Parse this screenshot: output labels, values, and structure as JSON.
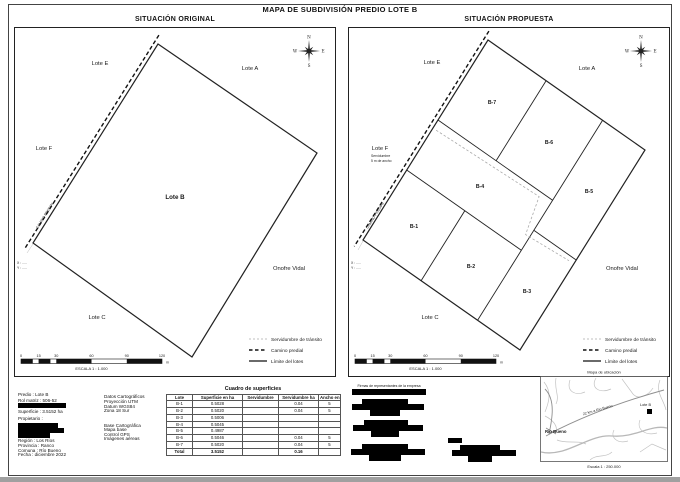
{
  "page": {
    "title": "MAPA DE SUBDIVISIÓN PREDIO LOTE B"
  },
  "panels": {
    "original": {
      "title": "SITUACIÓN ORIGINAL",
      "main_lot": "Lote B"
    },
    "proposed": {
      "title": "SITUACIÓN PROPUESTA",
      "lots": [
        "B-1",
        "B-2",
        "B-3",
        "B-4",
        "B-5",
        "B-6",
        "B-7"
      ],
      "servidumbre_note_line1": "Servidumbre",
      "servidumbre_note_line2": "5 m de ancho"
    }
  },
  "labels": {
    "lote_e": "Lote E",
    "lote_a": "Lote A",
    "lote_f": "Lote F",
    "lote_c": "Lote C",
    "neighbor_owner": "Onofre Vidal",
    "camino": "CAMINO PREDIAL",
    "coord_x": "X : .....",
    "coord_y": "Y : ....."
  },
  "compass": {
    "n": "N",
    "e": "E",
    "s": "S",
    "w": "W"
  },
  "legend": {
    "items": [
      {
        "label": "Servidumbre de tránsito",
        "style": "dash-light"
      },
      {
        "label": "Camino predial",
        "style": "dash-bold"
      },
      {
        "label": "Límite del lotes",
        "style": "solid"
      }
    ]
  },
  "scalebar": {
    "ticks": [
      "0",
      "15",
      "30",
      "60",
      "90",
      "120"
    ],
    "unit": "m",
    "label": "ESCALA 1 : 1.000"
  },
  "footer": {
    "info": {
      "predio": "Predio : Lote B",
      "rol": "Rol matriz : 506-52",
      "superficie": "Superficie : 3.5152 ha",
      "propietario": "Propietario :",
      "region": "Región : Los Ríos",
      "provincia": "Provincia : Ranco",
      "comuna": "Comuna : Río Bueno",
      "fecha": "Fecha : diciembre 2022"
    },
    "carto": {
      "title": "Datos Cartográficos",
      "l1": "Proyección UTM",
      "l2": "Datum WGS84",
      "l3": "Zona 18 Sur",
      "base_title": "Base Cartográfica",
      "b1": "Mapa base",
      "b2": "Control GPS",
      "b3": "Imágenes aéreas"
    },
    "table": {
      "title": "Cuadro de superficies",
      "headers": [
        "Lote",
        "Superficie en ha",
        "Servidumbre",
        "Servidumbre ha",
        "Ancho en m"
      ],
      "rows": [
        [
          "B-1",
          "0.5028",
          "",
          "0.04",
          "5"
        ],
        [
          "B-2",
          "0.5020",
          "",
          "0.04",
          "5"
        ],
        [
          "B-3",
          "0.5006",
          "",
          "",
          ""
        ],
        [
          "B-4",
          "0.5045",
          "",
          "",
          ""
        ],
        [
          "B-5",
          "0.4987",
          "",
          "",
          ""
        ],
        [
          "B-6",
          "0.5046",
          "",
          "0.04",
          "5"
        ],
        [
          "B-7",
          "0.5020",
          "",
          "0.04",
          "5"
        ]
      ],
      "total": [
        "Total",
        "3.5152",
        "",
        "0.16",
        ""
      ]
    },
    "signatures": {
      "caption": "Firmas de representantes de la empresa"
    },
    "minimap": {
      "caption": "Mapa de ubicación",
      "city": "Río Bueno",
      "site": "Lote B",
      "road_label": "22 km a Río Bueno",
      "scale": "Escala 1 : 250.000"
    }
  },
  "colors": {
    "line": "#1a1a1a",
    "faint": "#9a9a9a",
    "redaction": "#000000"
  }
}
